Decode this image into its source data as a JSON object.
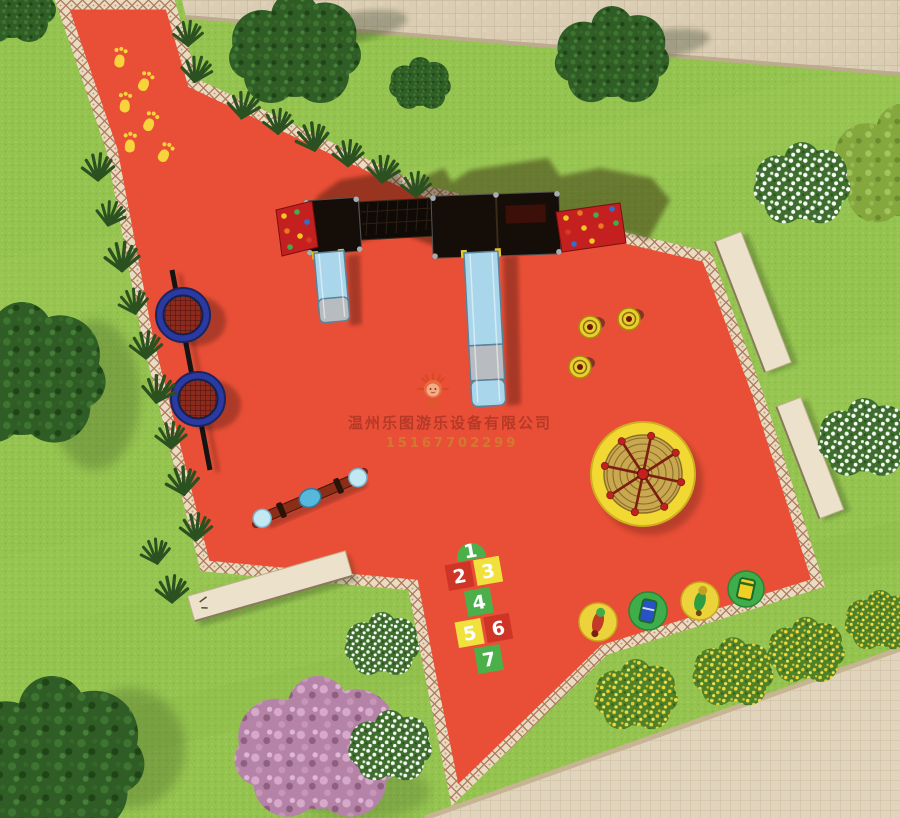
{
  "watermark": {
    "company": "温州乐图游乐设备有限公司",
    "phone": "15167702299",
    "logo": "mascot-sun-figure"
  },
  "hopscotch": {
    "cells": [
      {
        "label": "1",
        "color": "#4cb04a"
      },
      {
        "label": "2",
        "color": "#cf3526"
      },
      {
        "label": "3",
        "color": "#f0e13c"
      },
      {
        "label": "4",
        "color": "#4cb04a"
      },
      {
        "label": "5",
        "color": "#f0e13c"
      },
      {
        "label": "6",
        "color": "#cf3526"
      },
      {
        "label": "7",
        "color": "#4cb04a"
      }
    ]
  },
  "palette": {
    "safety_surface_red": "#e94f36",
    "grass_green": "#95c350",
    "pavement_tan": "#dacdb3",
    "path_border_cream": "#e9dcc3",
    "equipment_yellow": "#f2d832",
    "trampoline_blue": "#2a3aa0",
    "slide_blue": "#a9d6eb",
    "climb_wall_red": "#c42020",
    "footprint_yellow": "#f8d43c"
  },
  "equipment": [
    {
      "name": "duck-footprint-path",
      "count": 6
    },
    {
      "name": "climbing-frame-with-slides",
      "count": 2
    },
    {
      "name": "rock-climbing-walls",
      "count": 2
    },
    {
      "name": "inclined-trampoline-discs",
      "count": 2
    },
    {
      "name": "seesaw",
      "count": 1
    },
    {
      "name": "rope-climbing-dome",
      "count": 1
    },
    {
      "name": "spinner-seats",
      "count": 3
    },
    {
      "name": "spring-riders",
      "count": 4
    },
    {
      "name": "hopscotch-court",
      "count": 1
    },
    {
      "name": "benches",
      "count": 3
    }
  ]
}
